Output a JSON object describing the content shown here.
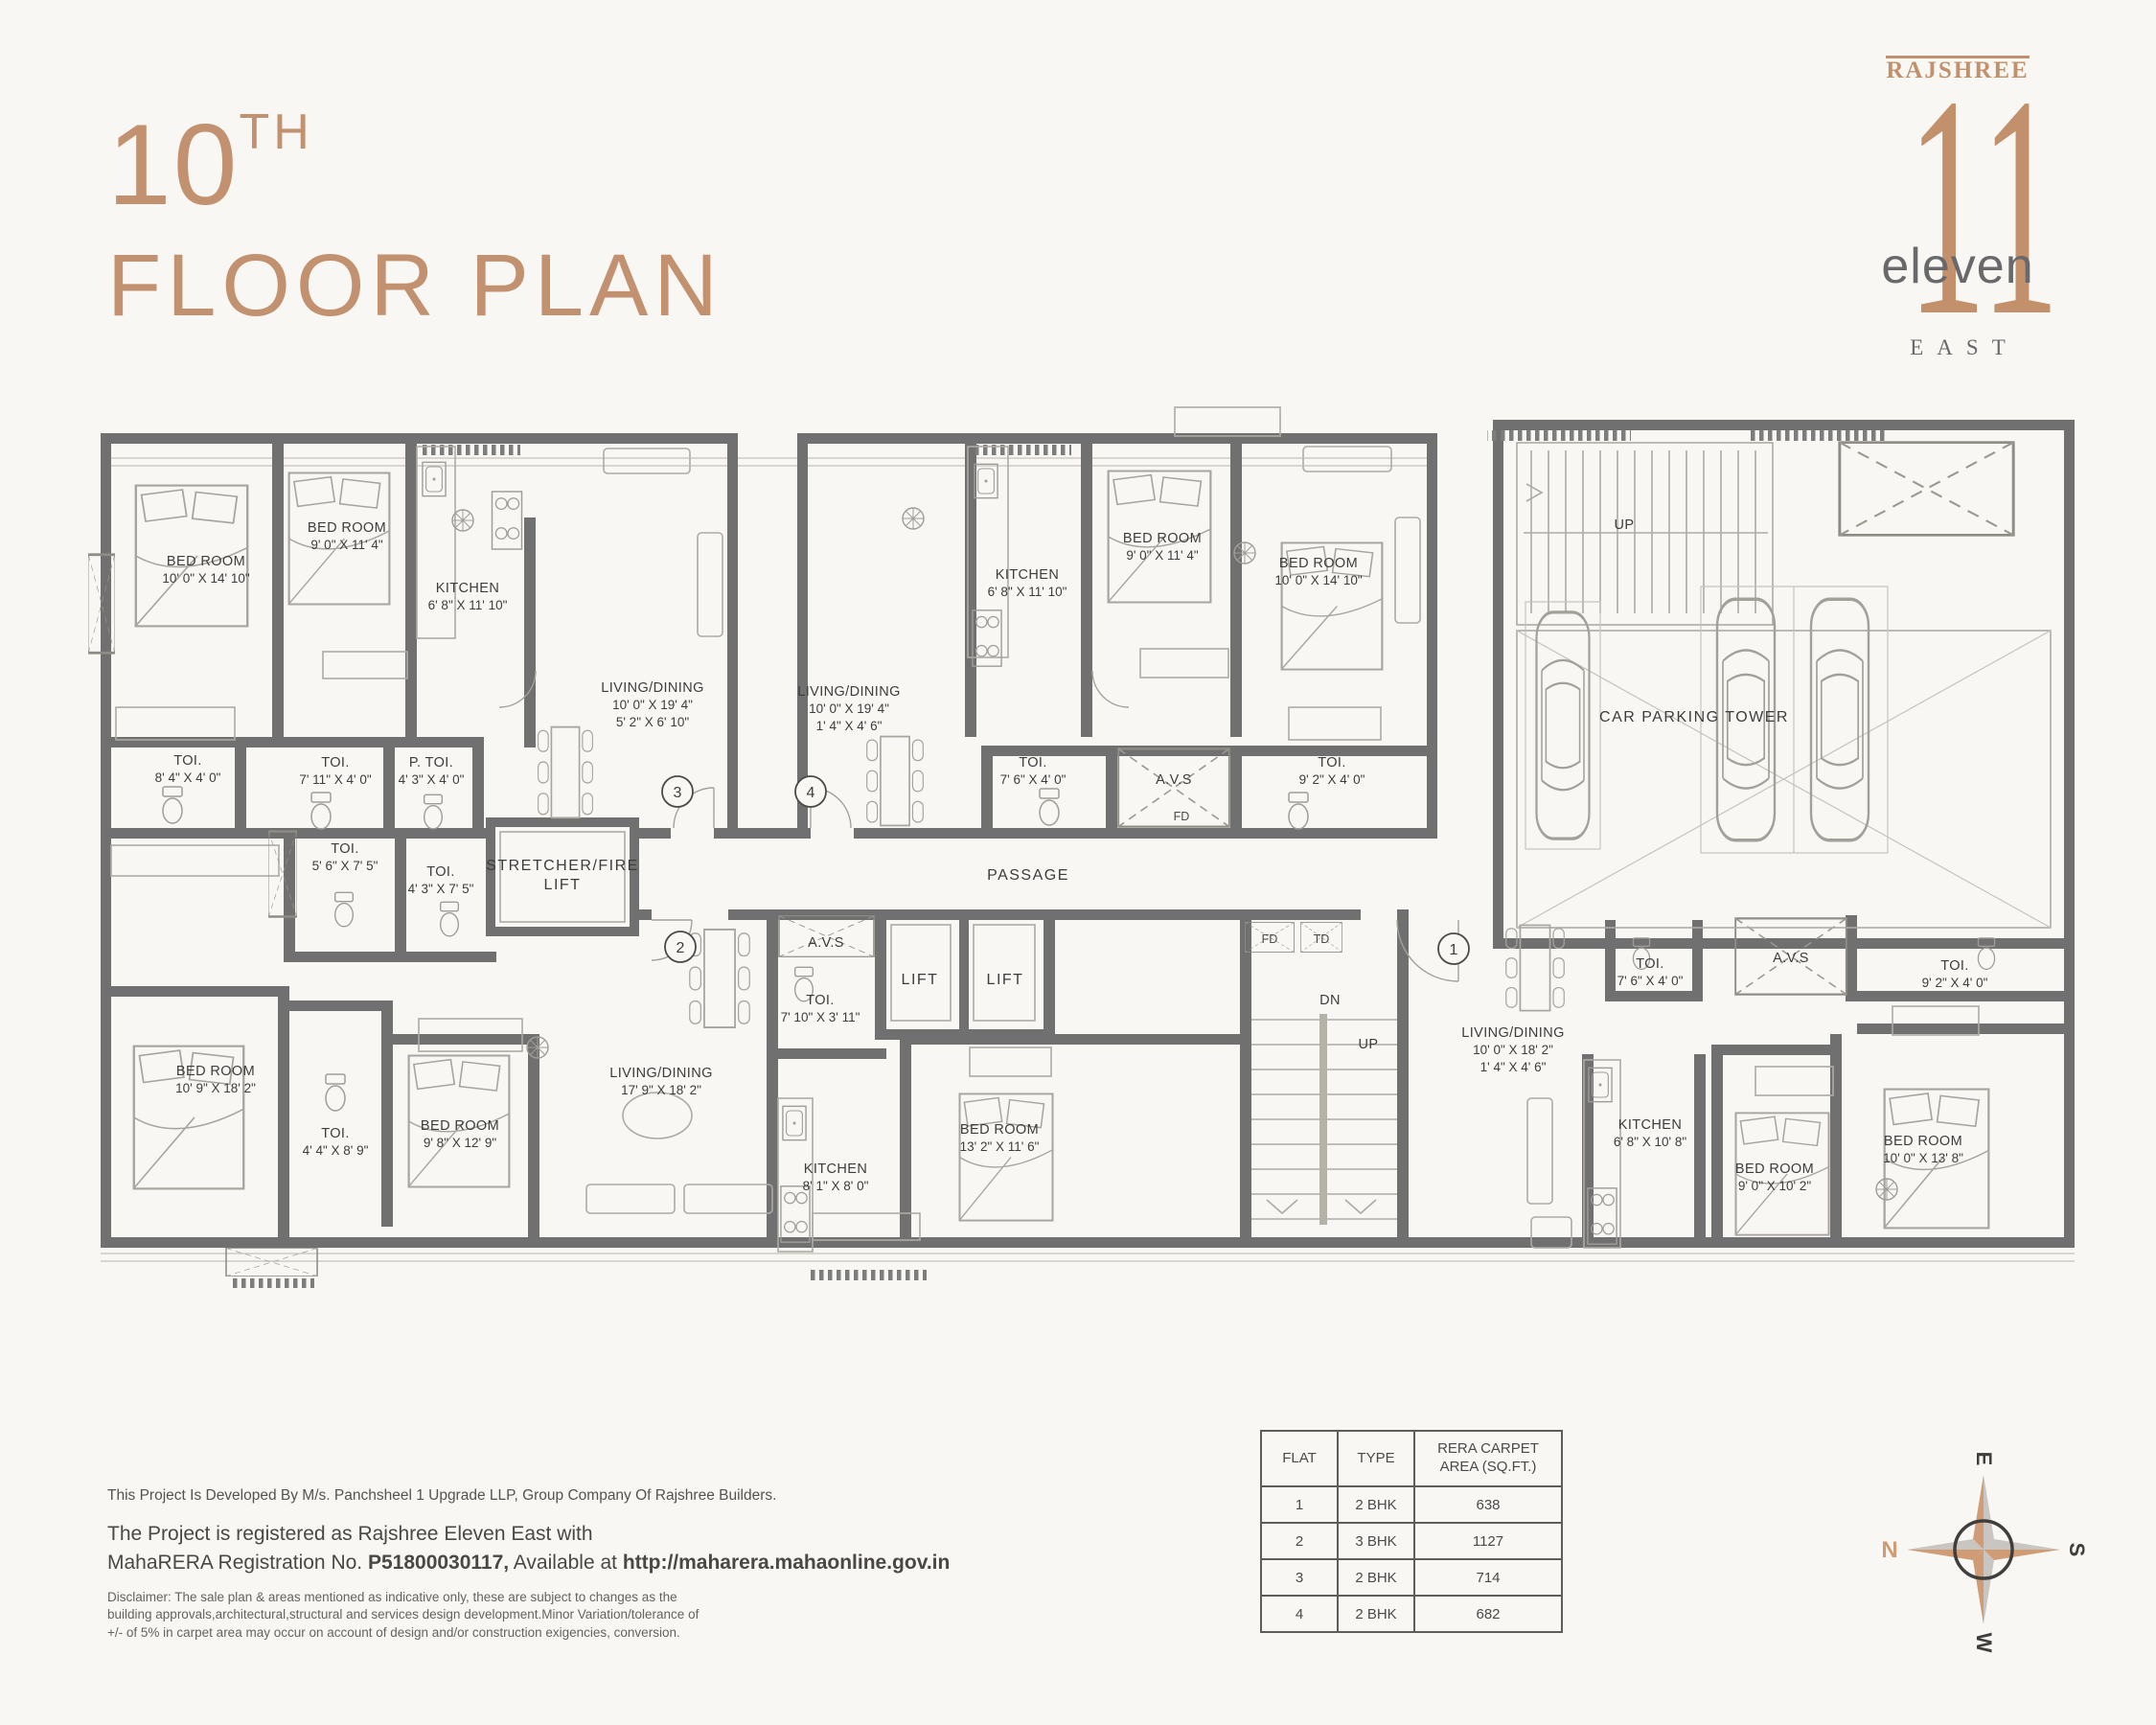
{
  "header": {
    "number": "10",
    "ordinal": "TH",
    "title": "FLOOR PLAN"
  },
  "logo": {
    "brand": "RAJSHREE",
    "numeral": "11",
    "word": "eleven",
    "sub": "EAST"
  },
  "plan": {
    "flat3": {
      "number": "3",
      "bed1": {
        "name": "BED ROOM",
        "dim": "10' 0\" X 14' 10\""
      },
      "bed2": {
        "name": "BED ROOM",
        "dim": "9' 0\" X 11' 4\""
      },
      "kitchen": {
        "name": "KITCHEN",
        "dim": "6' 8\" X 11' 10\""
      },
      "living": {
        "name": "LIVING/DINING",
        "dim": "10' 0\" X 19' 4\"",
        "dim2": "5' 2\" X 6' 10\""
      },
      "toi1": {
        "name": "TOI.",
        "dim": "8' 4\" X 4' 0\""
      },
      "toi2": {
        "name": "TOI.",
        "dim": "7' 11\" X 4' 0\""
      },
      "ptoi": {
        "name": "P. TOI.",
        "dim": "4' 3\" X 4' 0\""
      }
    },
    "flat4": {
      "number": "4",
      "living": {
        "name": "LIVING/DINING",
        "dim": "10' 0\" X 19' 4\"",
        "dim2": "1' 4\" X 4' 6\""
      },
      "kitchen": {
        "name": "KITCHEN",
        "dim": "6' 8\" X 11' 10\""
      },
      "bed1": {
        "name": "BED ROOM",
        "dim": "9' 0\" X 11' 4\""
      },
      "bed2": {
        "name": "BED ROOM",
        "dim": "10' 0\" X 14' 10\""
      },
      "toi1": {
        "name": "TOI.",
        "dim": "7' 6\" X 4' 0\""
      },
      "toi2": {
        "name": "TOI.",
        "dim": "9' 2\" X 4' 0\""
      }
    },
    "flat2": {
      "number": "2",
      "living": {
        "name": "LIVING/DINING",
        "dim": "17' 9\" X 18' 2\""
      },
      "kitchen": {
        "name": "KITCHEN",
        "dim": "8' 1\" X 8' 0\""
      },
      "bed1": {
        "name": "BED ROOM",
        "dim": "10' 9\" X 18' 2\""
      },
      "bed2": {
        "name": "BED ROOM",
        "dim": "9' 8\" X 12' 9\""
      },
      "bed3": {
        "name": "BED ROOM",
        "dim": "13' 2\" X 11' 6\""
      },
      "toi1": {
        "name": "TOI.",
        "dim": "4' 4\" X 8' 9\""
      },
      "toi2": {
        "name": "TOI.",
        "dim": "5' 6\" X 7' 5\""
      },
      "toi3": {
        "name": "TOI.",
        "dim": "4' 3\" X 7' 5\""
      },
      "toi4": {
        "name": "TOI.",
        "dim": "7' 10\" X 3' 11\""
      }
    },
    "flat1": {
      "number": "1",
      "living": {
        "name": "LIVING/DINING",
        "dim": "10' 0\" X 18' 2\"",
        "dim2": "1' 4\" X 4' 6\""
      },
      "kitchen": {
        "name": "KITCHEN",
        "dim": "6' 8\" X 10' 8\""
      },
      "bed1": {
        "name": "BED ROOM",
        "dim": "9' 0\" X 10' 2\""
      },
      "bed2": {
        "name": "BED ROOM",
        "dim": "10' 0\" X 13' 8\""
      },
      "toi1": {
        "name": "TOI.",
        "dim": "7' 6\" X 4' 0\""
      },
      "toi2": {
        "name": "TOI.",
        "dim": "9' 2\" X 4' 0\""
      }
    },
    "common": {
      "stretcher_line1": "STRETCHER/FIRE",
      "stretcher_line2": "LIFT",
      "passage": "PASSAGE",
      "lift": "LIFT",
      "car_parking": "CAR PARKING TOWER",
      "avs": "A.V.S",
      "fd": "FD",
      "td": "TD",
      "up": "UP",
      "dn": "DN"
    }
  },
  "footer": {
    "dev_line": "This Project Is Developed By M/s. Panchsheel 1 Upgrade LLP,  Group Company Of Rajshree Builders.",
    "reg_line1": "The Project is registered as Rajshree Eleven East with",
    "reg_prefix": "MahaRERA Registration No. ",
    "reg_no": "P51800030117,",
    "reg_mid": " Available at ",
    "reg_url": "http://maharera.mahaonline.gov.in",
    "disclaimer": "Disclaimer: The sale plan & areas mentioned as indicative only, these are subject to changes as the building approvals,architectural,structural and services design development.Minor Variation/tolerance of +/- of 5% in carpet area may occur on account of design and/or construction exigencies, conversion."
  },
  "table": {
    "headers": [
      "FLAT",
      "TYPE",
      "RERA CARPET AREA (SQ.FT.)"
    ],
    "rows": [
      [
        "1",
        "2 BHK",
        "638"
      ],
      [
        "2",
        "3 BHK",
        "1127"
      ],
      [
        "3",
        "2 BHK",
        "714"
      ],
      [
        "4",
        "2 BHK",
        "682"
      ]
    ]
  },
  "compass": {
    "n": "N",
    "e": "E",
    "s": "S",
    "w": "W"
  },
  "colors": {
    "accent": "#c2906c",
    "wall": "#707070",
    "logo_gray": "#69696b"
  }
}
